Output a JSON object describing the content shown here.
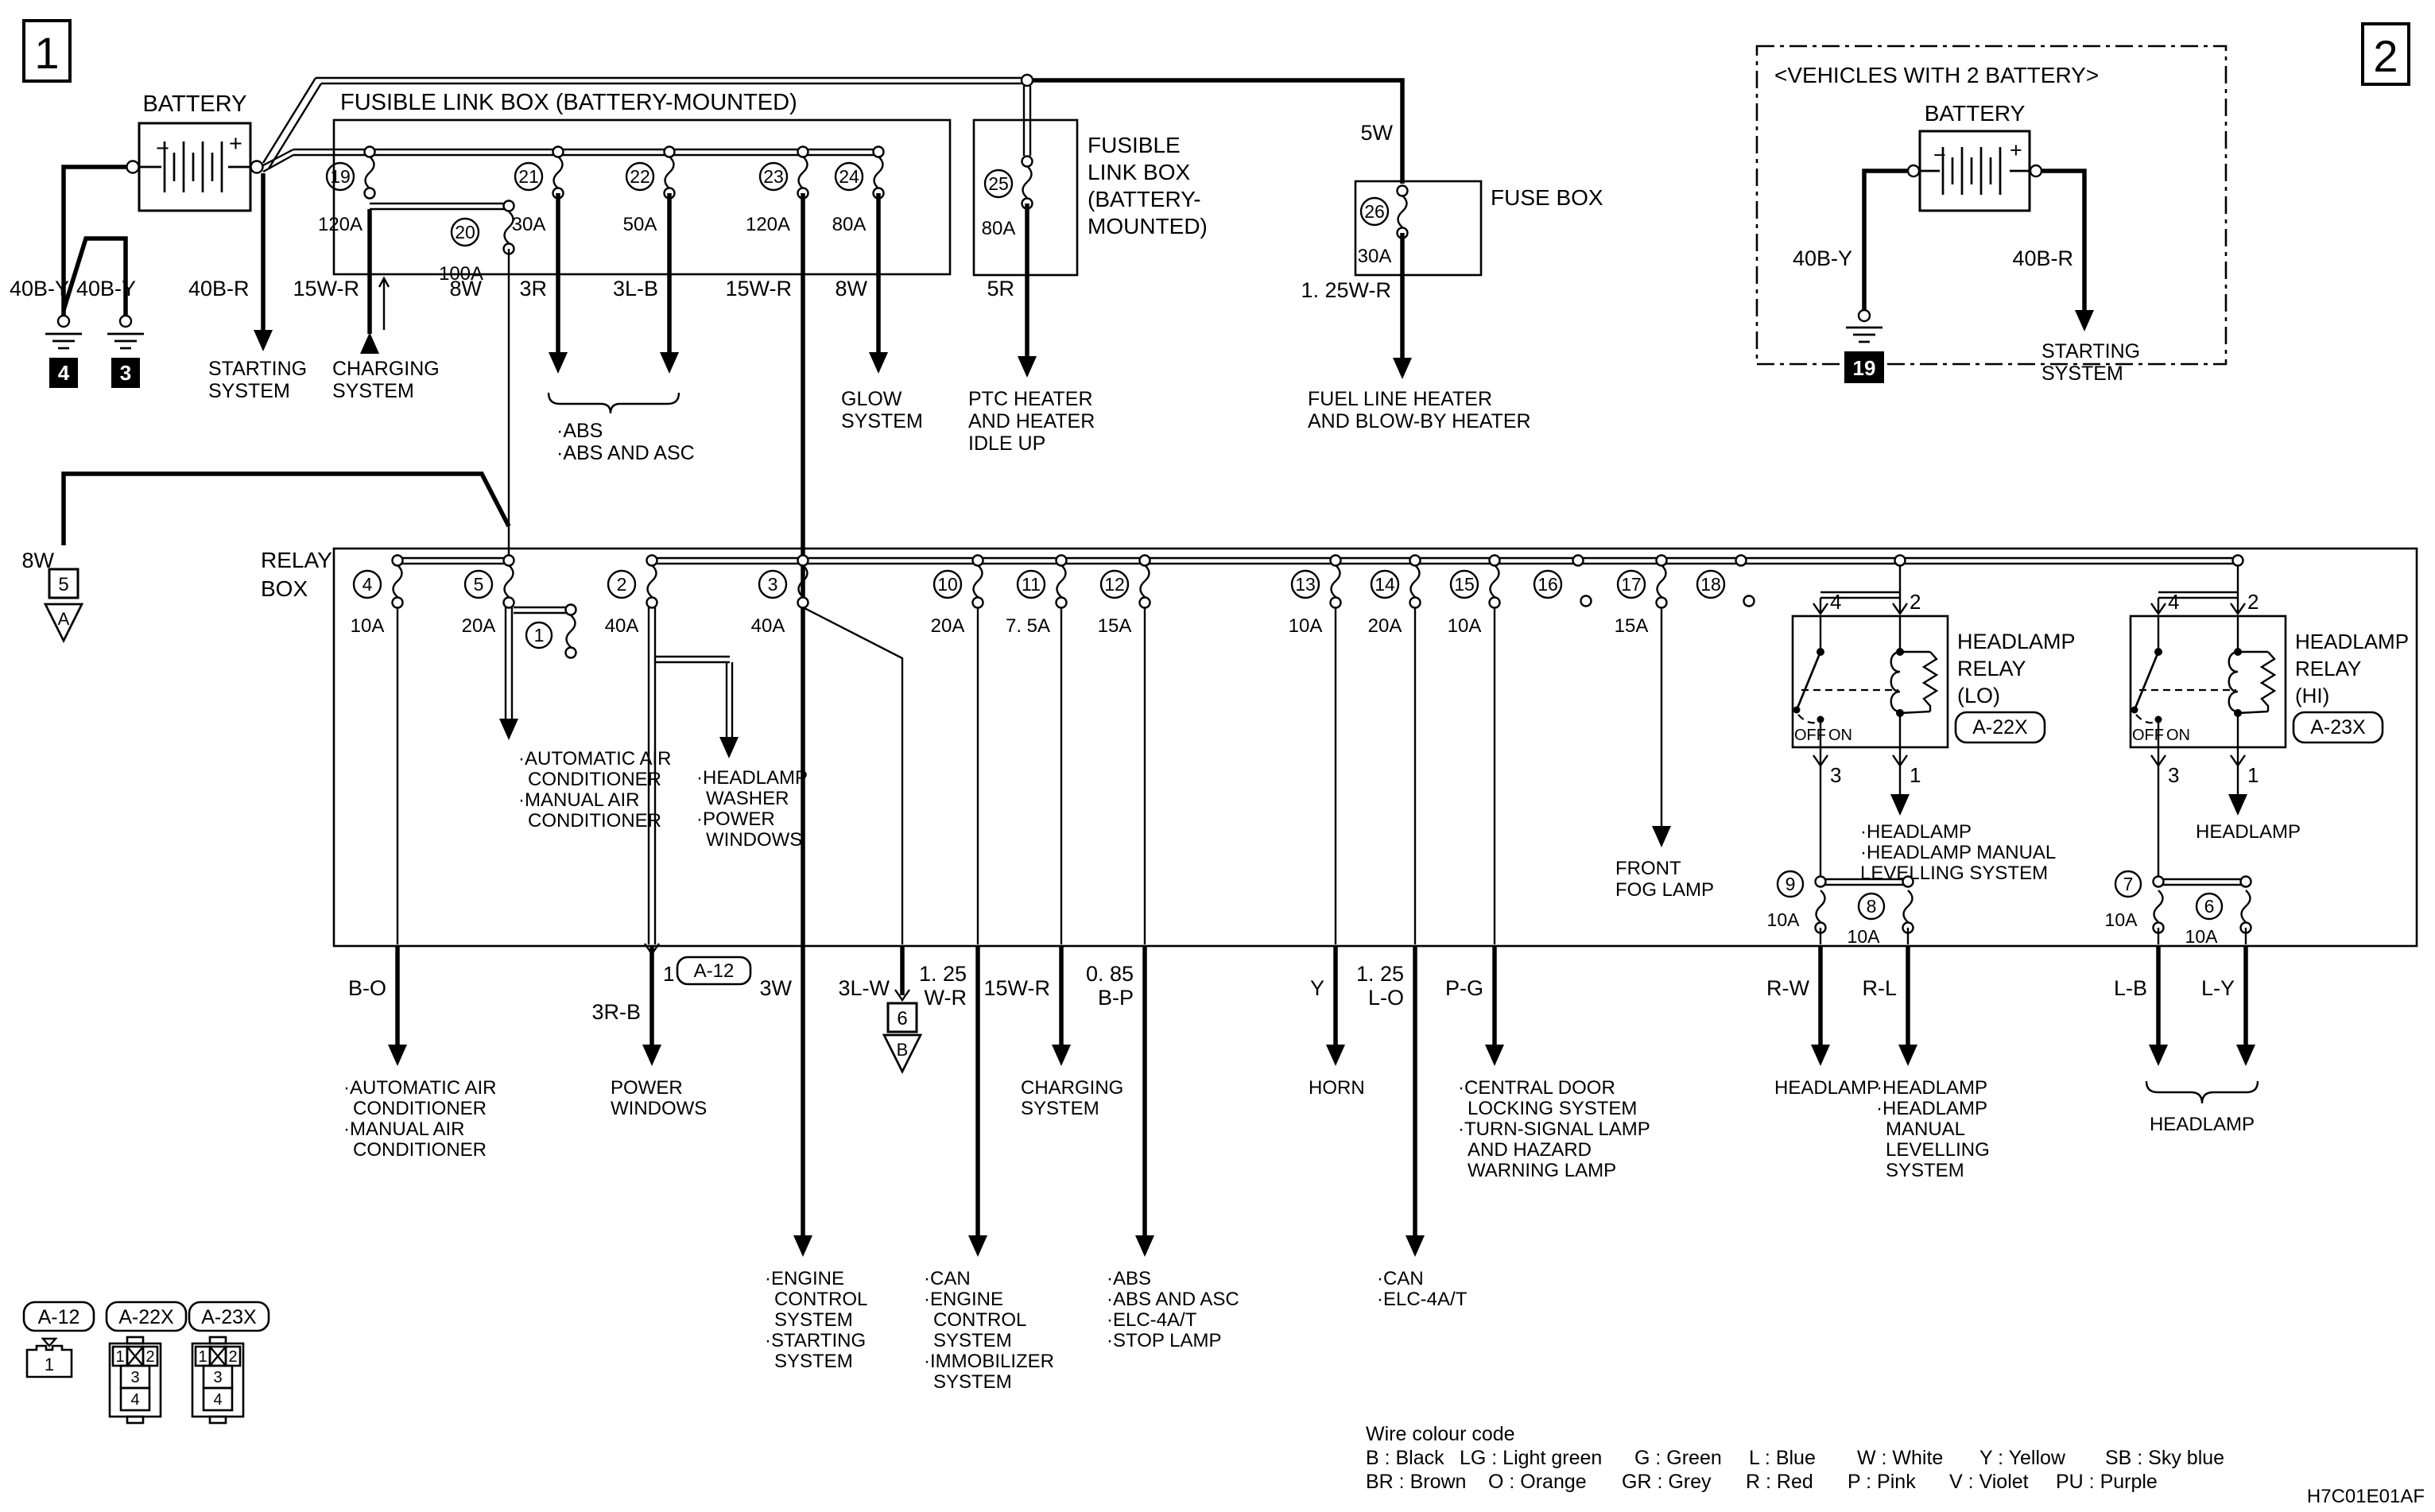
{
  "doc": {
    "page1": "1",
    "page2": "2",
    "code": "H7C01E01AF"
  },
  "battery1": {
    "title": "BATTERY",
    "minus": "−",
    "plus": "+",
    "neg_label1": "40B-Y",
    "neg_label2": "40B-Y",
    "pos_label": "40B-R",
    "gnd1": "4",
    "gnd2": "3",
    "starting": [
      "STARTING",
      "SYSTEM"
    ]
  },
  "flb1": {
    "title": "FUSIBLE LINK BOX (BATTERY-MOUNTED)",
    "f19": {
      "num": "19",
      "amp": "120A"
    },
    "f20": {
      "num": "20",
      "amp": "100A"
    },
    "f21": {
      "num": "21",
      "amp": "30A"
    },
    "f22": {
      "num": "22",
      "amp": "50A"
    },
    "f23": {
      "num": "23",
      "amp": "120A"
    },
    "f24": {
      "num": "24",
      "amp": "80A"
    },
    "out_charge_label": "15W-R",
    "charging": [
      "CHARGING",
      "SYSTEM"
    ],
    "out20_label": "8W",
    "out21_label": "3R",
    "out22_label": "3L-B",
    "abs": [
      "·ABS",
      "·ABS AND ASC"
    ],
    "out23_label": "15W-R",
    "out24_label": "8W",
    "glow": [
      "GLOW",
      "SYSTEM"
    ]
  },
  "flb2": {
    "title": [
      "FUSIBLE",
      "LINK BOX",
      "(BATTERY-",
      "MOUNTED)"
    ],
    "f25": {
      "num": "25",
      "amp": "80A"
    },
    "out_label": "5R",
    "ptc": [
      "PTC HEATER",
      "AND HEATER",
      "IDLE UP"
    ]
  },
  "fusebox": {
    "title": "FUSE BOX",
    "feed_label": "5W",
    "f26": {
      "num": "26",
      "amp": "30A"
    },
    "out_label": "1. 25W-R",
    "fuel": [
      "FUEL LINE HEATER",
      "AND BLOW-BY HEATER"
    ]
  },
  "ground5": {
    "wire": "8W",
    "num": "5",
    "tri": "A"
  },
  "relaybox": {
    "title": [
      "RELAY",
      "BOX"
    ],
    "f4": {
      "num": "4",
      "amp": "10A"
    },
    "f5": {
      "num": "5",
      "amp": "20A"
    },
    "f1": {
      "num": "1"
    },
    "f2": {
      "num": "2",
      "amp": "40A"
    },
    "f3": {
      "num": "3",
      "amp": "40A"
    },
    "f10": {
      "num": "10",
      "amp": "20A"
    },
    "f11": {
      "num": "11",
      "amp": "7. 5A"
    },
    "f12": {
      "num": "12",
      "amp": "15A"
    },
    "f13": {
      "num": "13",
      "amp": "10A"
    },
    "f14": {
      "num": "14",
      "amp": "20A"
    },
    "f15": {
      "num": "15",
      "amp": "10A"
    },
    "f16": {
      "num": "16"
    },
    "f17": {
      "num": "17",
      "amp": "15A"
    },
    "f18": {
      "num": "18"
    },
    "f9": {
      "num": "9",
      "amp": "10A"
    },
    "f8": {
      "num": "8",
      "amp": "10A"
    },
    "f7": {
      "num": "7",
      "amp": "10A"
    },
    "f6": {
      "num": "6",
      "amp": "10A"
    },
    "ac_inner": [
      "·AUTOMATIC AIR",
      "CONDITIONER",
      "·MANUAL AIR",
      "CONDITIONER"
    ],
    "hw_inner": [
      "·HEADLAMP",
      "WASHER",
      "·POWER",
      "WINDOWS"
    ],
    "fog": [
      "FRONT",
      "FOG LAMP"
    ]
  },
  "relay_lo": {
    "name": [
      "HEADLAMP",
      "RELAY",
      "(LO)"
    ],
    "conn": "A-22X",
    "off": "OFF",
    "on": "ON",
    "pin4": "4",
    "pin2": "2",
    "pin3": "3",
    "pin1": "1",
    "out": [
      "·HEADLAMP",
      "·HEADLAMP MANUAL",
      "LEVELLING SYSTEM"
    ]
  },
  "relay_hi": {
    "name": [
      "HEADLAMP",
      "RELAY",
      "(HI)"
    ],
    "conn": "A-23X",
    "off": "OFF",
    "on": "ON",
    "pin4": "4",
    "pin2": "2",
    "pin3": "3",
    "pin1": "1",
    "out": "HEADLAMP"
  },
  "outputs": {
    "b_o": {
      "label": "B-O",
      "text": [
        "·AUTOMATIC AIR",
        "CONDITIONER",
        "·MANUAL AIR",
        "CONDITIONER"
      ]
    },
    "r3b": {
      "label": "3R-B",
      "pin": "1",
      "conn": "A-12",
      "text": [
        "POWER",
        "WINDOWS"
      ]
    },
    "w3": {
      "label": "3W",
      "text": [
        "·ENGINE",
        "CONTROL",
        "SYSTEM",
        "·STARTING",
        "SYSTEM"
      ]
    },
    "lw3": {
      "label": "3L-W",
      "num": "6",
      "tri": "B"
    },
    "wr125": {
      "label1": "1. 25",
      "label2": "W-R",
      "text": [
        "·CAN",
        "·ENGINE",
        "CONTROL",
        "SYSTEM",
        "·IMMOBILIZER",
        "SYSTEM"
      ]
    },
    "wr15": {
      "label": "15W-R",
      "text": [
        "CHARGING",
        "SYSTEM"
      ]
    },
    "bp085": {
      "label1": "0. 85",
      "label2": "B-P",
      "text": [
        "·ABS",
        "·ABS AND ASC",
        "·ELC-4A/T",
        "·STOP LAMP"
      ]
    },
    "y": {
      "label": "Y",
      "text": "HORN"
    },
    "lo125": {
      "label1": "1. 25",
      "label2": "L-O",
      "text": [
        "·CAN",
        "·ELC-4A/T"
      ]
    },
    "pg": {
      "label": "P-G",
      "text": [
        "·CENTRAL DOOR",
        "LOCKING SYSTEM",
        "·TURN-SIGNAL LAMP",
        "AND HAZARD",
        "WARNING LAMP"
      ]
    },
    "rw": {
      "label": "R-W",
      "text": "HEADLAMP"
    },
    "rl": {
      "label": "R-L",
      "text": [
        "·HEADLAMP",
        "·HEADLAMP",
        "MANUAL",
        "LEVELLING",
        "SYSTEM"
      ]
    },
    "lb": {
      "label": "L-B"
    },
    "ly": {
      "label": "L-Y"
    },
    "lbly_text": "HEADLAMP"
  },
  "battery2": {
    "note": "<VEHICLES WITH 2 BATTERY>",
    "title": "BATTERY",
    "minus": "−",
    "plus": "+",
    "neg_label": "40B-Y",
    "pos_label": "40B-R",
    "gnd": "19",
    "starting": [
      "STARTING",
      "SYSTEM"
    ]
  },
  "legend": {
    "a12": "A-12",
    "a22x": "A-22X",
    "a23x": "A-23X",
    "c1": "1",
    "c2": "2",
    "c3": "3",
    "c4": "4"
  },
  "colour_code": {
    "title": "Wire colour code",
    "row1": [
      "B : Black",
      "LG : Light green",
      "G : Green",
      "L : Blue",
      "W : White",
      "Y : Yellow",
      "SB : Sky blue"
    ],
    "row2": [
      "BR : Brown",
      "O : Orange",
      "GR : Grey",
      "R : Red",
      "P : Pink",
      "V : Violet",
      "PU : Purple"
    ]
  }
}
